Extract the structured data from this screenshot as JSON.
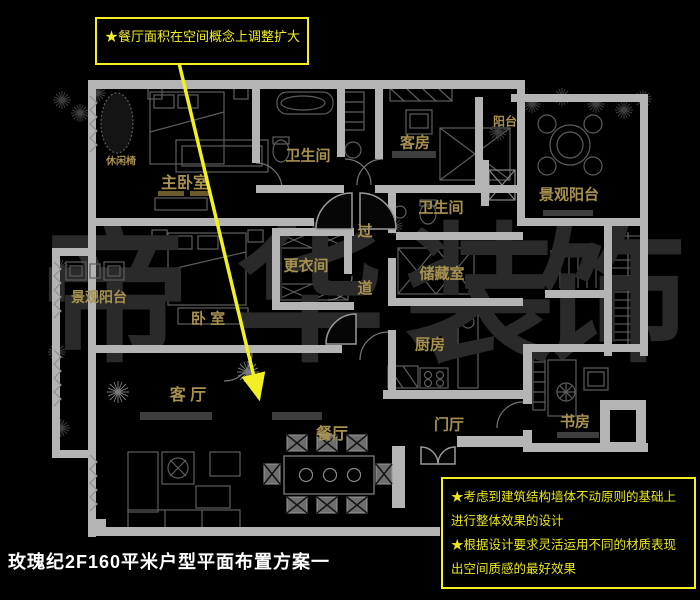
{
  "title": "玫瑰纪2F160平米户型平面布置方案一",
  "annotation_top": {
    "text": "★餐厅面积在空间概念上调整扩大",
    "arrow_target": "dining-room"
  },
  "notes_box": {
    "lines": [
      "★考虑到建筑结构墙体不动原则的基础上",
      "进行整体效果的设计",
      "★根据设计要求灵活运用不同的材质表现",
      "出空间质感的最好效果"
    ]
  },
  "watermark_chars": [
    "帝",
    "华",
    "装",
    "饰"
  ],
  "colors": {
    "background": "#000000",
    "wall": "#b4b4b4",
    "label_gold": "#a8914f",
    "accent_yellow": "#f2ef25",
    "watermark": "#2a2a2a",
    "furniture_line": "#5d5d5d"
  },
  "rooms": [
    {
      "key": "master-bedroom",
      "label": "主卧室",
      "x": 185,
      "y": 181,
      "size": 16
    },
    {
      "key": "leisure-chair",
      "label": "休闲椅",
      "x": 121,
      "y": 160,
      "size": 10
    },
    {
      "key": "bathroom-1",
      "label": "卫生间",
      "x": 308,
      "y": 155,
      "size": 15
    },
    {
      "key": "guest-room",
      "label": "客房",
      "x": 415,
      "y": 142,
      "size": 15
    },
    {
      "key": "balcony-top-right",
      "label": "阳台",
      "x": 505,
      "y": 121,
      "size": 12
    },
    {
      "key": "scenic-balcony-right",
      "label": "景观阳台",
      "x": 569,
      "y": 194,
      "size": 15
    },
    {
      "key": "bathroom-2",
      "label": "卫生间",
      "x": 441,
      "y": 207,
      "size": 15
    },
    {
      "key": "corridor",
      "label": "过道",
      "x": 364,
      "y": 280,
      "size": 15,
      "vertical": true
    },
    {
      "key": "dressing-room",
      "label": "更衣间",
      "x": 306,
      "y": 265,
      "size": 15
    },
    {
      "key": "storage-room",
      "label": "储藏室",
      "x": 442,
      "y": 273,
      "size": 15
    },
    {
      "key": "scenic-balcony-left",
      "label": "景观阳台",
      "x": 99,
      "y": 297,
      "size": 14
    },
    {
      "key": "bedroom",
      "label": "卧  室",
      "x": 208,
      "y": 318,
      "size": 15
    },
    {
      "key": "kitchen",
      "label": "厨房",
      "x": 430,
      "y": 344,
      "size": 15
    },
    {
      "key": "living-room",
      "label": "客  厅",
      "x": 188,
      "y": 393,
      "size": 16
    },
    {
      "key": "dining-room",
      "label": "餐厅",
      "x": 332,
      "y": 432,
      "size": 16
    },
    {
      "key": "entry-hall",
      "label": "门厅",
      "x": 449,
      "y": 424,
      "size": 15
    },
    {
      "key": "study",
      "label": "书房",
      "x": 575,
      "y": 421,
      "size": 15
    }
  ]
}
